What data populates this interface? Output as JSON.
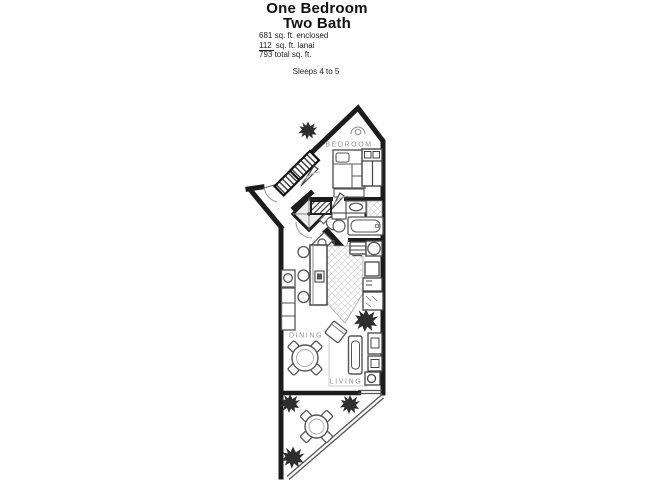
{
  "header": {
    "title_line1": "One Bedroom",
    "title_line2": "Two Bath",
    "area_enclosed": "681 sq. ft. enclosed",
    "area_lanai_value": "112",
    "area_lanai_rest": "sq. ft. lanai",
    "area_total": "793 total sq. ft.",
    "sleeps": "Sleeps 4 to 5"
  },
  "floorplan": {
    "labels": {
      "bedroom": "BEDROOM",
      "dining": "DINING",
      "living": "LIVING"
    },
    "colors": {
      "wall": "#1c1c1c",
      "furniture": "#5a5a5a",
      "room_label": "#8f8f8f",
      "background": "#ffffff"
    }
  }
}
